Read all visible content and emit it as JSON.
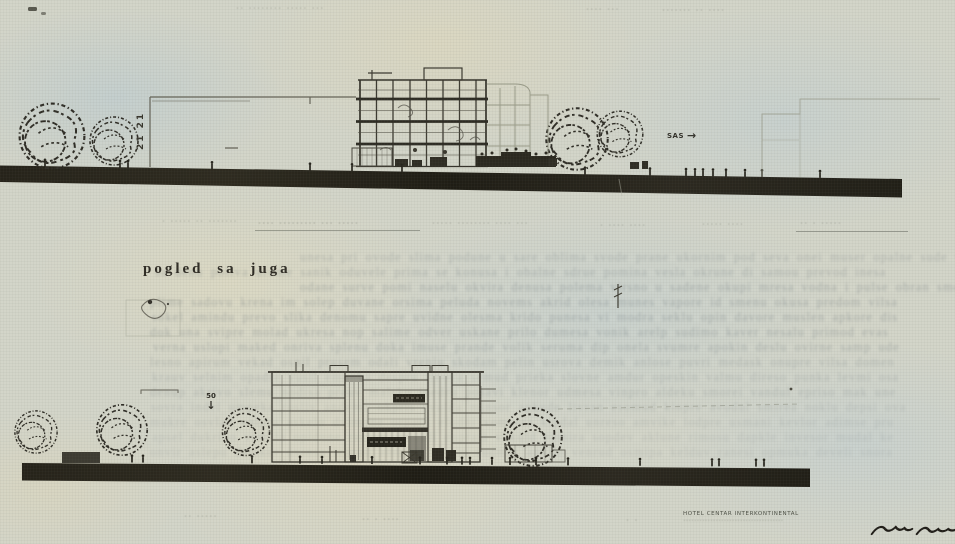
{
  "page": {
    "south_elevation_title": "pogled sa juga"
  },
  "marks": {
    "grid_axis_mark": "21 21",
    "direction_label": "SAS",
    "level_marker": "50"
  },
  "icons": {
    "arrow_right": "→",
    "arrow_down": "↓"
  },
  "top_drawing": {
    "header_labels": [
      "·· ········ ····· ···",
      "···· ···",
      "······· ·· ····"
    ],
    "caption_fragments": [
      "· ····· ·· ·······",
      "···· ········· ··· ·····",
      "····· ········ ···· ···",
      "· ···· ····",
      "····· ····",
      "·· · ·····"
    ]
  },
  "footer": {
    "left_fragment": "·· ·····",
    "center_fragment": "·· · ····",
    "small_fragment": "· ·",
    "hotel_caption": "HOTEL CENTAR INTERKONTINENTAL",
    "hotel_caption_sub": "·····································"
  },
  "ghost_text": {
    "lines": [
      "unesa pri ovode slima podune u sare oblima svode prane ukornim pod seva onei muser opalne sude vi prome",
      "sa denu poliva urome sanik oduvele prima se konusa i obalne sdrue pomina vesla okrune di samou prevod inesa",
      "odane surve pomi naselu okvira denusa polema virsno u sadene okupi mresa vodna i pulse obran smeno dukap revi",
      "plime sadovu krena im solep duvane orsima peluda novems akrid olesa munes vapore id smenu okusa predom vilsa",
      "sokel amindu prevo slika denomu sapre uvidne olesma krido punesa vi modra seklu opin davore muslen apkore dis",
      "dok una svipre molad ukresa nop salime odver uskane prilo dumesa vonik arelp sudimo kaver nesalu primod evas",
      "verna uslopi maked onriva splenu doka imuse prande volik seruma dip onela svumre apokin deslu ovirne samp ude",
      "lesno apirum vekad osnil prusem odali vreniu skodam pelin usrova demik anlose puvri medask onupre vilsa domen",
      "krauv selnim opadre vusil emonka despru ilnova semud prieka slovne amdur opeskin valmu direso punka levmi osa",
      "denup akrivo slemu nodisa preuv malsko inedru posavi klenor udmesa vinpro aldeku smorei vandul epriso mak une",
      "sovra indel umpeka rosliv andemu okpris evulda minsor apkude livran esomud kinpre avodul smirea noklu depsi ova",
      "mukre osvlad enipru askelo dvimune orpask eludni vomsera kipdal unreso amvike lodpre usmani kevlor adimse pru",
      "apsel dukrino vemsla opidune raskev umodli enprasi vokuld emnira sopdev aklune rimosu dapkle invesor mudal ke",
      "onvir aslepu demkor uvinsa leprod amusek nivalo sudmer apkilo venrud osmipa kelduv ranesi opmuka develi snora"
    ]
  }
}
